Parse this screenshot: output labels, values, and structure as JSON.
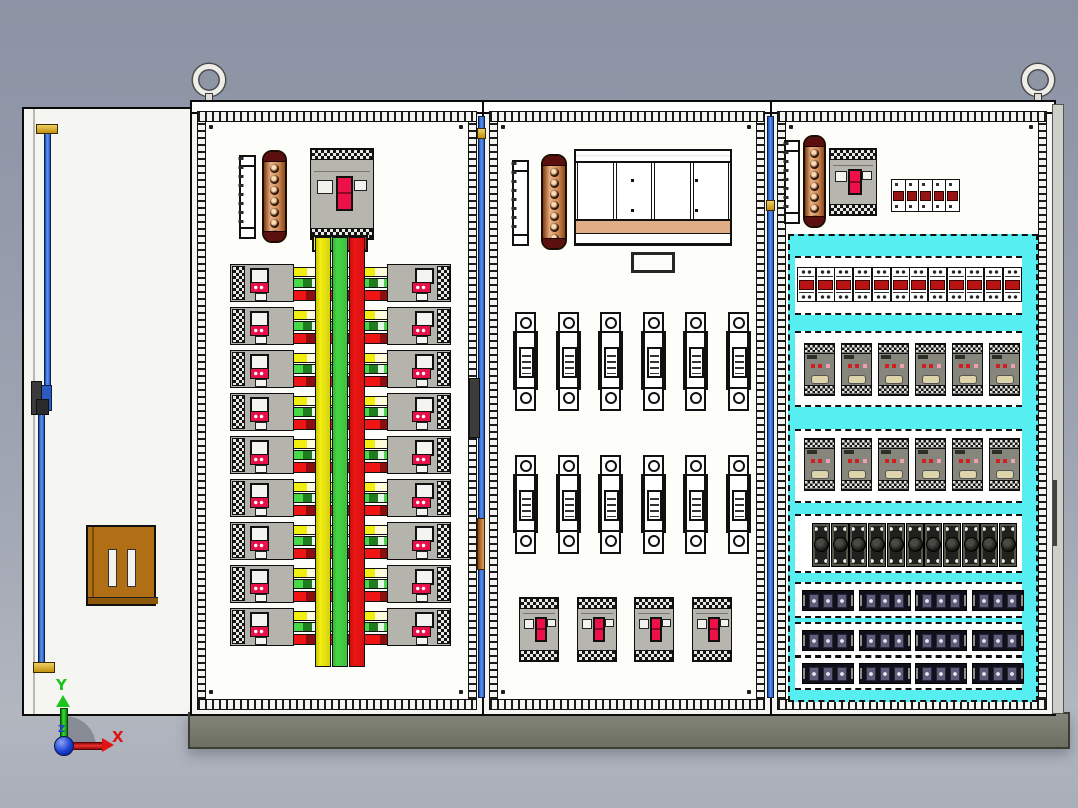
{
  "viewport": {
    "type": "cad-3d-assembly-view",
    "subject": "three-bay electrical distribution cabinet",
    "background_top": "#8b93a4",
    "background_bottom": "#b2b6bf"
  },
  "origin_triad": {
    "x": {
      "label": "X",
      "color": "#e01414"
    },
    "y": {
      "label": "Y",
      "color": "#1cc41c"
    },
    "z": {
      "label": "Z",
      "color": "#2a3fd0"
    }
  },
  "model": {
    "door": {
      "rod_color_hint": "blue-lock-rod",
      "pocket_color": "#b06f15"
    },
    "lifting_eyes": 2,
    "plinth_color": "#7b7c6e",
    "cabinet1": {
      "breaker_rows": 9,
      "busbar_colors": {
        "l1": "#f2ee10",
        "l2": "#46d846",
        "l3": "#f01515"
      },
      "copper_bar_holes": 8,
      "has_main_breaker": true
    },
    "cabinet2": {
      "fuse_rows": [
        6,
        6
      ],
      "mccb_count": 4,
      "copper_bar_holes": 8
    },
    "cabinet3": {
      "highlight_color": "#57eef1",
      "terminal_count": 12,
      "contactor_rows": [
        6,
        6
      ],
      "fuseholder_count": 11,
      "strip_rows": [
        4,
        4,
        4
      ],
      "strips_per_group": 3,
      "copper_bar_holes": 8,
      "top_terminal_columns": 5
    }
  }
}
